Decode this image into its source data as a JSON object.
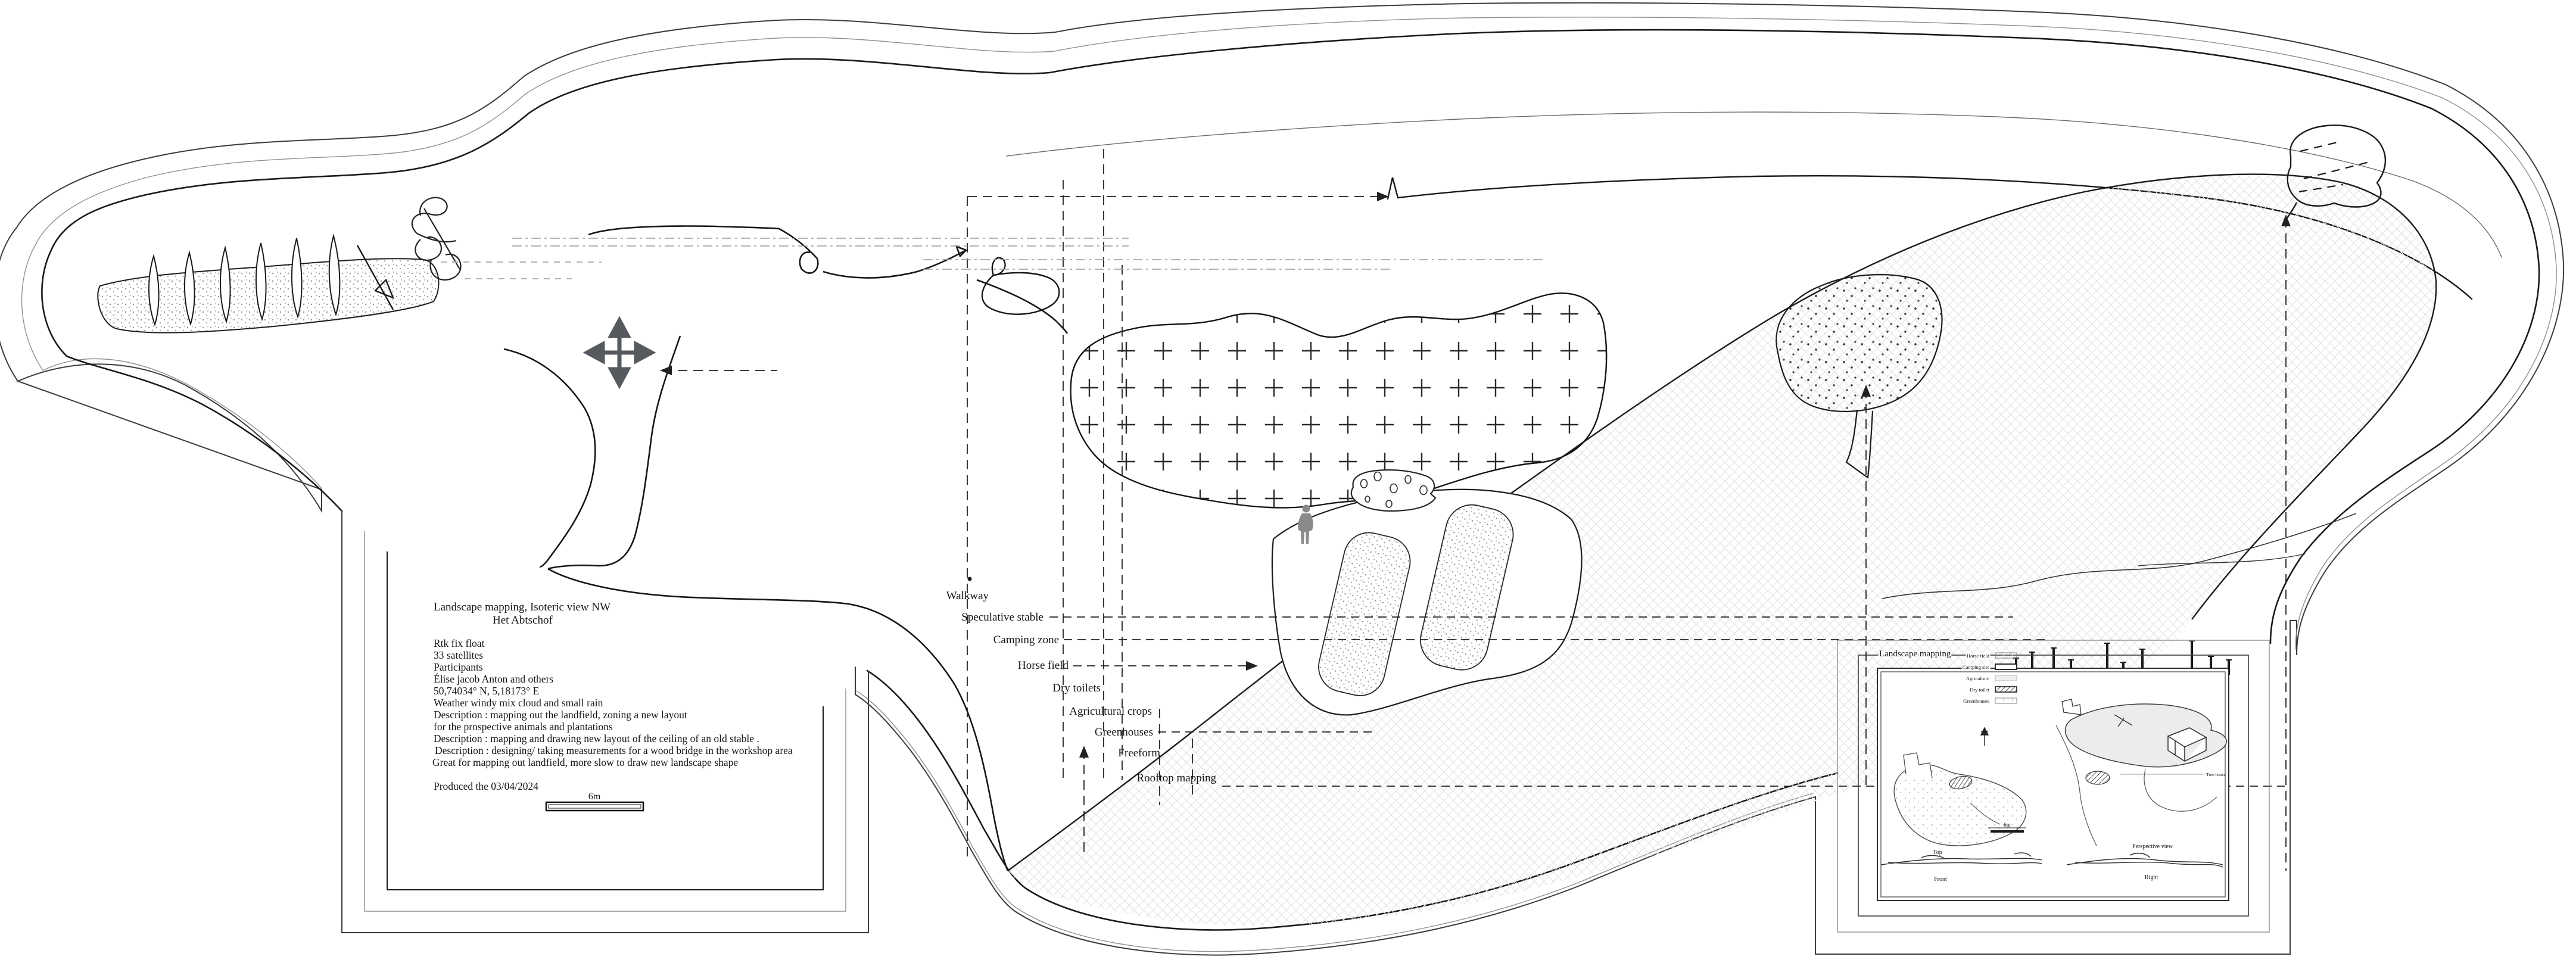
{
  "document": {
    "kind": "hand-drawn landscape mapping site plan",
    "ink_color": "#1a1a1a",
    "paper_color": "#ffffff",
    "accent_gray": "#8a8a8a"
  },
  "title_block": {
    "title": "Landscape mapping, Isoteric view NW",
    "subtitle": "Het Abtschof",
    "details": [
      "Rtk fix float",
      "33 satellites",
      "Participants",
      "Élise jacob Anton and others",
      "50,74034° N, 5,18173° E",
      "Weather windy mix cloud and small rain",
      "Description : mapping out the landfield, zoning a new layout",
      "for the prospective animals and plantations",
      "Description : mapping and drawing new layout of the ceiling of an old stable .",
      "Description : designing/ taking measurements for a wood bridge in the workshop area",
      "Great for mapping out landfield, more slow to draw new landscape shape"
    ],
    "produced": "Produced the 03/04/2024",
    "scale_label": "6m"
  },
  "zones": [
    {
      "label": "Walkway"
    },
    {
      "label": "Speculative stable"
    },
    {
      "label": "Camping zone"
    },
    {
      "label": "Horse field"
    },
    {
      "label": "Dry toilets"
    },
    {
      "label": "Agricultural crops"
    },
    {
      "label": "Greenhouses"
    },
    {
      "label": "Freeform"
    },
    {
      "label": "Rooftop mapping"
    }
  ],
  "hatch_area": {
    "title": "Landscape mapping",
    "legend": [
      {
        "label": "Horse field"
      },
      {
        "label": "Camping site"
      },
      {
        "label": "Agriculture"
      },
      {
        "label": "Dry toilet"
      },
      {
        "label": "Greenhouses"
      }
    ]
  },
  "inset": {
    "view_top": "Top",
    "view_front": "Front",
    "view_perspective": "Perspective view",
    "view_right": "Right",
    "scale_label": "6m",
    "annotation": "Tree house"
  }
}
